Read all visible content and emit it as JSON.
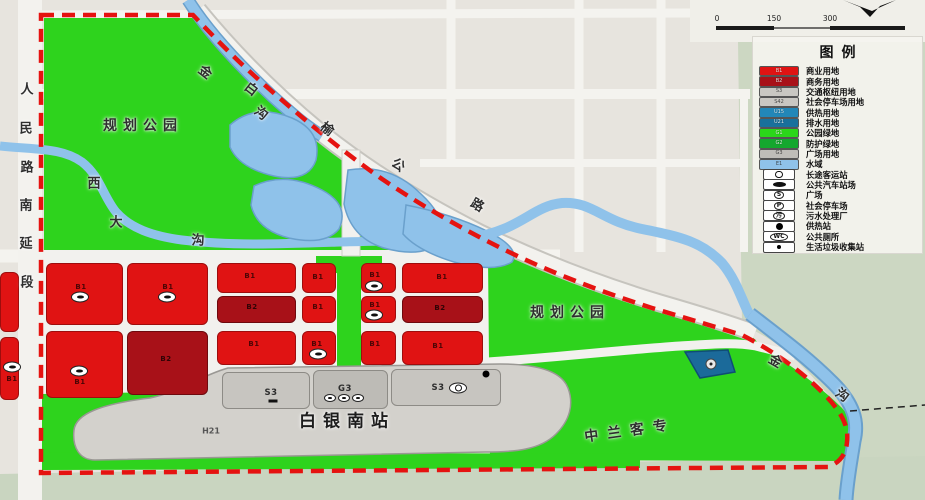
{
  "colors": {
    "red": "#e01313",
    "darkred": "#a81118",
    "gray": "#c7c5c0",
    "park_green": "#2ed31d",
    "protect_green": "#14a72e",
    "water": "#8fc2ea",
    "boundary_red": "#e51310",
    "drain_blue": "#1b6a9a"
  },
  "scalebar": {
    "ticks": [
      "0",
      "150",
      "300"
    ]
  },
  "legend": {
    "title": "图例",
    "items": [
      {
        "type": "swatch",
        "code": "B1",
        "color": "#e01313",
        "label": "商业用地"
      },
      {
        "type": "swatch",
        "code": "B2",
        "color": "#a81118",
        "label": "商务用地"
      },
      {
        "type": "swatch",
        "code": "S3",
        "color": "#c9c7c2",
        "light": true,
        "label": "交通枢纽用地"
      },
      {
        "type": "swatch",
        "code": "S42",
        "color": "#c9c7c2",
        "light": true,
        "label": "社会停车场用地"
      },
      {
        "type": "swatch",
        "code": "U15",
        "color": "#2287b8",
        "label": "供热用地"
      },
      {
        "type": "swatch",
        "code": "U21",
        "color": "#19709c",
        "label": "排水用地"
      },
      {
        "type": "swatch",
        "code": "G1",
        "color": "#2bd61a",
        "label": "公园绿地"
      },
      {
        "type": "swatch",
        "code": "G2",
        "color": "#14a72e",
        "label": "防护绿地"
      },
      {
        "type": "swatch",
        "code": "G3",
        "color": "#bfbdb8",
        "light": true,
        "label": "广场用地"
      },
      {
        "type": "swatch",
        "code": "E1",
        "color": "#8fc2ea",
        "light": true,
        "label": "水域"
      },
      {
        "type": "icon",
        "shape": "oval-wheel",
        "icon": "coach-station",
        "label": "长途客运站"
      },
      {
        "type": "icon",
        "shape": "oval-disc",
        "icon": "public-bus-station",
        "label": "公共汽车站场"
      },
      {
        "type": "icon",
        "shape": "oval-text",
        "glyph": "S",
        "icon": "square",
        "label": "广场"
      },
      {
        "type": "icon",
        "shape": "oval-text",
        "glyph": "P",
        "icon": "public-parking",
        "label": "社会停车场"
      },
      {
        "type": "icon",
        "shape": "oval-text",
        "glyph": "污",
        "icon": "sewage-plant",
        "label": "污水处理厂"
      },
      {
        "type": "icon",
        "shape": "disc",
        "icon": "heating-station",
        "label": "供热站"
      },
      {
        "type": "icon",
        "shape": "oval-text",
        "glyph": "WC",
        "icon": "public-toilet",
        "label": "公共厕所"
      },
      {
        "type": "icon",
        "shape": "dot",
        "icon": "waste-collection",
        "label": "生活垃圾收集站"
      }
    ]
  },
  "map_labels": {
    "park_left": "规划公园",
    "park_right": "规划公园",
    "station": "白银南站",
    "railway": "中兰客专",
    "h21": "H21",
    "road_left": [
      "人",
      "民",
      "路",
      "南",
      "延",
      "段"
    ],
    "river_top": [
      "金",
      "白",
      "沟"
    ],
    "stream": [
      "西",
      "大",
      "沟"
    ],
    "diag_road": [
      "榆",
      "公",
      "路"
    ],
    "river_right": [
      "金",
      "沟"
    ]
  },
  "parcels": [
    {
      "x": 0,
      "y": 272,
      "w": 19,
      "h": 60,
      "c": "red"
    },
    {
      "x": 0,
      "y": 337,
      "w": 19,
      "h": 63,
      "c": "red",
      "code": "B1",
      "lx": 11,
      "ly": 378
    },
    {
      "x": 46,
      "y": 263,
      "w": 77,
      "h": 62,
      "c": "red",
      "code": "B1",
      "lx": 80,
      "ly": 286
    },
    {
      "x": 127,
      "y": 263,
      "w": 81,
      "h": 62,
      "c": "red",
      "code": "B1",
      "lx": 167,
      "ly": 286
    },
    {
      "x": 217,
      "y": 263,
      "w": 79,
      "h": 30,
      "c": "red",
      "code": "B1",
      "lx": 249,
      "ly": 275
    },
    {
      "x": 217,
      "y": 296,
      "w": 79,
      "h": 27,
      "c": "darkred",
      "code": "B2",
      "lx": 251,
      "ly": 306
    },
    {
      "x": 217,
      "y": 331,
      "w": 79,
      "h": 34,
      "c": "red",
      "code": "B1",
      "lx": 253,
      "ly": 343
    },
    {
      "x": 302,
      "y": 263,
      "w": 34,
      "h": 30,
      "c": "red",
      "code": "B1",
      "lx": 317,
      "ly": 276
    },
    {
      "x": 361,
      "y": 263,
      "w": 35,
      "h": 30,
      "c": "red",
      "code": "B1",
      "lx": 374,
      "ly": 274
    },
    {
      "x": 302,
      "y": 296,
      "w": 34,
      "h": 27,
      "c": "red",
      "code": "B1",
      "lx": 317,
      "ly": 306
    },
    {
      "x": 361,
      "y": 296,
      "w": 35,
      "h": 27,
      "c": "red",
      "code": "B1",
      "lx": 374,
      "ly": 304
    },
    {
      "x": 302,
      "y": 331,
      "w": 34,
      "h": 34,
      "c": "red",
      "code": "B1",
      "lx": 316,
      "ly": 343
    },
    {
      "x": 361,
      "y": 331,
      "w": 35,
      "h": 34,
      "c": "red",
      "code": "B1",
      "lx": 374,
      "ly": 343
    },
    {
      "x": 402,
      "y": 263,
      "w": 81,
      "h": 30,
      "c": "red",
      "code": "B1",
      "lx": 441,
      "ly": 276
    },
    {
      "x": 402,
      "y": 296,
      "w": 81,
      "h": 27,
      "c": "darkred",
      "code": "B2",
      "lx": 439,
      "ly": 307
    },
    {
      "x": 402,
      "y": 331,
      "w": 81,
      "h": 34,
      "c": "red",
      "code": "B1",
      "lx": 437,
      "ly": 345
    },
    {
      "x": 46,
      "y": 331,
      "w": 77,
      "h": 67,
      "c": "red",
      "code": "B1",
      "lx": 79,
      "ly": 381
    },
    {
      "x": 127,
      "y": 331,
      "w": 81,
      "h": 64,
      "c": "darkred",
      "code": "B2",
      "lx": 165,
      "ly": 358
    },
    {
      "x": 222,
      "y": 372,
      "w": 88,
      "h": 37,
      "c": "gray",
      "code": "S3",
      "lx": 270,
      "ly": 392
    },
    {
      "x": 313,
      "y": 370,
      "w": 75,
      "h": 39,
      "c": "gray2",
      "code": "G3",
      "lx": 344,
      "ly": 388
    },
    {
      "x": 391,
      "y": 369,
      "w": 110,
      "h": 37,
      "c": "gray",
      "code": "S3",
      "lx": 437,
      "ly": 387
    }
  ],
  "map_icons": [
    {
      "x": 80,
      "y": 297,
      "k": "station-oval",
      "n": "bus-station-icon"
    },
    {
      "x": 167,
      "y": 297,
      "k": "station-oval",
      "n": "bus-station-icon"
    },
    {
      "x": 374,
      "y": 286,
      "k": "station-oval",
      "n": "bus-station-icon"
    },
    {
      "x": 374,
      "y": 315,
      "k": "station-oval",
      "n": "bus-station-icon"
    },
    {
      "x": 318,
      "y": 354,
      "k": "station-oval",
      "n": "bus-station-icon"
    },
    {
      "x": 79,
      "y": 371,
      "k": "station-oval",
      "n": "bus-station-icon"
    },
    {
      "x": 12,
      "y": 367,
      "k": "station-oval",
      "n": "bus-station-icon"
    },
    {
      "x": 273,
      "y": 401,
      "k": "bar",
      "n": "public-bus-icon"
    },
    {
      "x": 330,
      "y": 398,
      "k": "mini-oval",
      "n": "plaza-facility-icon"
    },
    {
      "x": 344,
      "y": 398,
      "k": "mini-oval",
      "n": "plaza-facility-icon"
    },
    {
      "x": 358,
      "y": 398,
      "k": "mini-oval",
      "n": "plaza-facility-icon"
    },
    {
      "x": 458,
      "y": 388,
      "k": "coach-oval",
      "n": "coach-station-icon"
    },
    {
      "x": 486,
      "y": 374,
      "k": "dot-large",
      "n": "heating-station-icon"
    },
    {
      "x": 711,
      "y": 364,
      "k": "drain-circle",
      "n": "sewage-plant-icon"
    }
  ]
}
